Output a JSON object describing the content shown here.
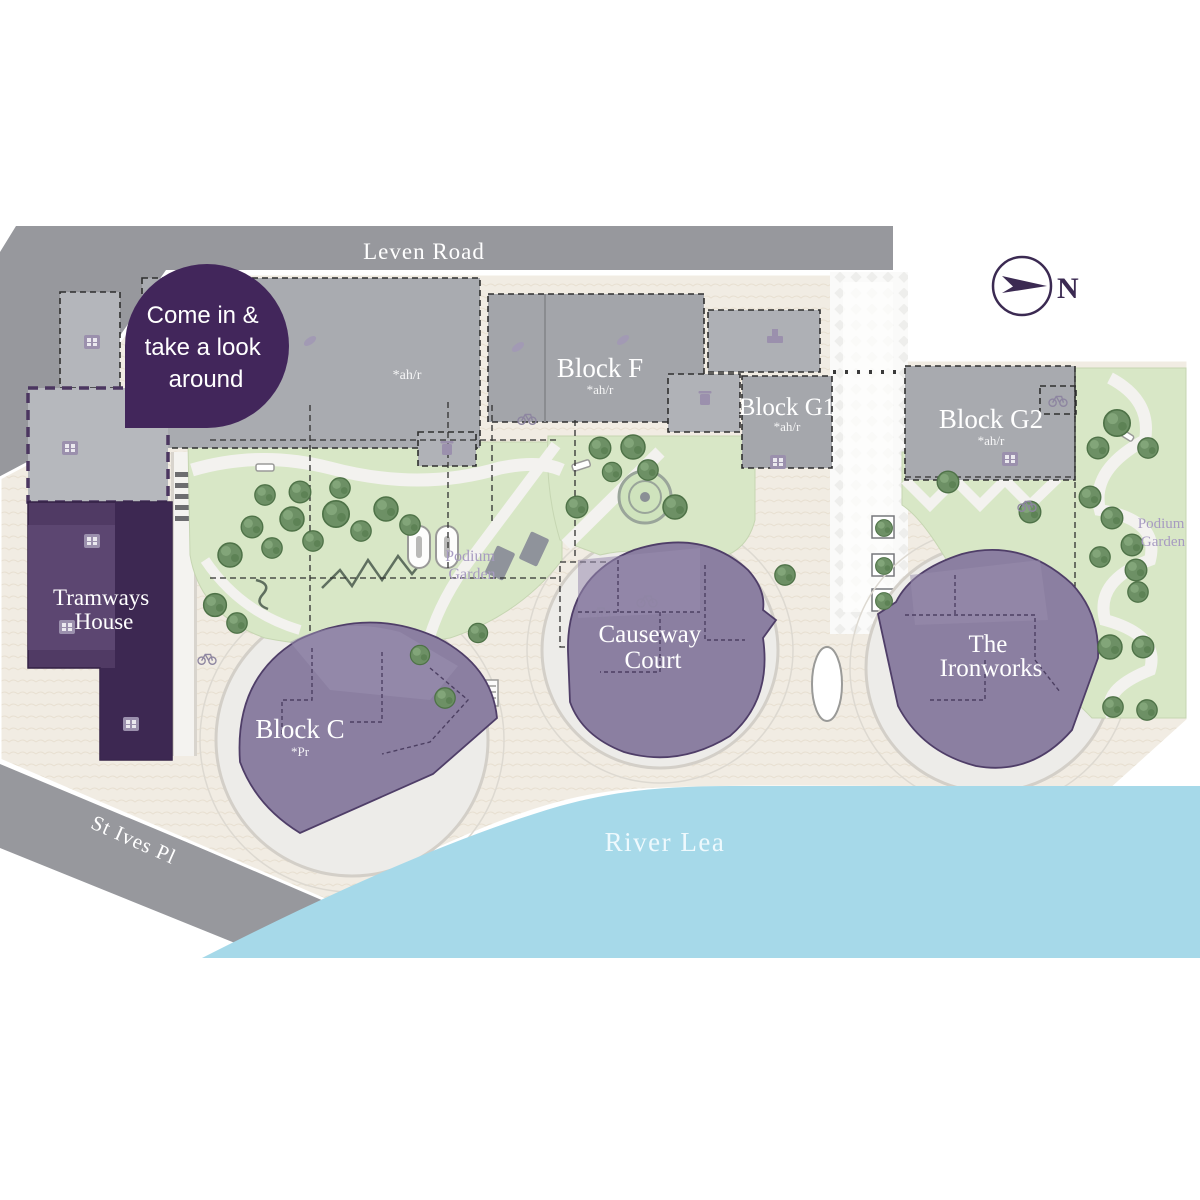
{
  "roads": {
    "leven": "Leven Road",
    "st_ives": "St Ives Pl"
  },
  "river": {
    "label": "River Lea"
  },
  "callout": {
    "lines": [
      "Come in &",
      "take a look",
      "around"
    ]
  },
  "compass": {
    "north": "N"
  },
  "buildings": {
    "tramways_house": {
      "name_lines": [
        "Tramways",
        "House"
      ]
    },
    "block_c": {
      "name": "Block C",
      "note": "*Pr"
    },
    "block_f": {
      "name": "Block F",
      "note": "*ah/r"
    },
    "block_g1": {
      "name": "Block G1",
      "note": "*ah/r"
    },
    "block_g2": {
      "name": "Block G2",
      "note": "*ah/r"
    },
    "west_building": {
      "note": "*ah/r"
    },
    "causeway_court": {
      "name_lines": [
        "Causeway",
        "Court"
      ]
    },
    "the_ironworks": {
      "name_lines": [
        "The",
        "Ironworks"
      ]
    }
  },
  "gardens": {
    "podium_garden_central": {
      "name_lines": [
        "Podium",
        "Garden"
      ]
    },
    "podium_garden_east": {
      "name_lines": [
        "Podium",
        "Garden"
      ]
    }
  },
  "colors": {
    "callout_bg": "#42265b",
    "sale_block": "#8b7fa1",
    "reserved_block": "#4a3459",
    "road": "#97989d",
    "water": "#a6d9e9",
    "garden": "#d8e7c6",
    "building_gray": "#a8aaaf",
    "ground": "#f1ece3",
    "accent_dark_purple": "#3b2a52"
  }
}
